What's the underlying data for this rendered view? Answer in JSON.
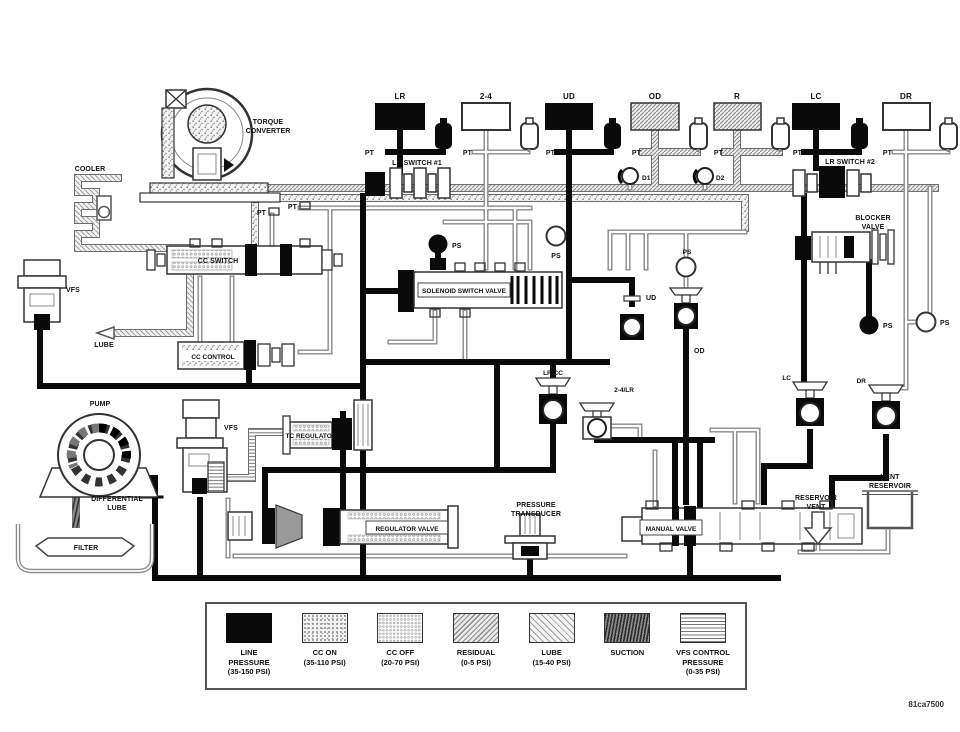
{
  "figure_number": "81ca7500",
  "port_labels": {
    "pt": "PT",
    "ps": "PS"
  },
  "check_balls": {
    "d1": "D1",
    "d2": "D2"
  },
  "clutches": [
    {
      "label": "LR",
      "fill": "line-pressure"
    },
    {
      "label": "2-4",
      "fill": "none"
    },
    {
      "label": "UD",
      "fill": "line-pressure"
    },
    {
      "label": "OD",
      "fill": "residual"
    },
    {
      "label": "R",
      "fill": "residual"
    },
    {
      "label": "LC",
      "fill": "line-pressure"
    },
    {
      "label": "DR",
      "fill": "none"
    }
  ],
  "solenoids": {
    "ud": "UD",
    "od": "OD",
    "lr_cc": "LR/CC",
    "two_four_lr": "2-4/LR",
    "lc": "LC",
    "dr": "DR"
  },
  "components": {
    "torque_converter": [
      "TORQUE",
      "CONVERTER"
    ],
    "cooler": "COOLER",
    "cc_switch": "CC SWITCH",
    "cc_control": "CC CONTROL",
    "vfs": "VFS",
    "lube": "LUBE",
    "pump": "PUMP",
    "differential_lube": [
      "DIFFERENTIAL",
      "LUBE"
    ],
    "filter": "FILTER",
    "tc_regulator": "TC REGULATOR",
    "regulator_valve": "REGULATOR VALVE",
    "pressure_transducer": [
      "PRESSURE",
      "TRANSDUCER"
    ],
    "manual_valve": "MANUAL VALVE",
    "solenoid_switch_valve": "SOLENOID SWITCH VALVE",
    "blocker_valve": [
      "BLOCKER",
      "VALVE"
    ],
    "vent_reservoir": [
      "VENT",
      "RESERVOIR"
    ],
    "reservoir_vent": [
      "RESERVOIR",
      "VENT"
    ],
    "lr_switch_1": "LR SWITCH #1",
    "lr_switch_2": "LR SWITCH #2"
  },
  "legend": {
    "items": [
      {
        "name": "line-pressure",
        "lines": [
          "LINE",
          "PRESSURE",
          "(35-150 PSI)"
        ]
      },
      {
        "name": "cc-on",
        "lines": [
          "CC ON",
          "(35-110 PSI)"
        ]
      },
      {
        "name": "cc-off",
        "lines": [
          "CC OFF",
          "(20-70 PSI)"
        ]
      },
      {
        "name": "residual",
        "lines": [
          "RESIDUAL",
          "(0-5 PSI)"
        ]
      },
      {
        "name": "lube",
        "lines": [
          "LUBE",
          "(15-40 PSI)"
        ]
      },
      {
        "name": "suction",
        "lines": [
          "SUCTION"
        ]
      },
      {
        "name": "vfs-control",
        "lines": [
          "VFS CONTROL",
          "PRESSURE",
          "(0-35 PSI)"
        ]
      }
    ]
  },
  "colors": {
    "line_pressure": "#000000",
    "pipe_gray": "#8a8a8a",
    "ink": "#333333"
  }
}
